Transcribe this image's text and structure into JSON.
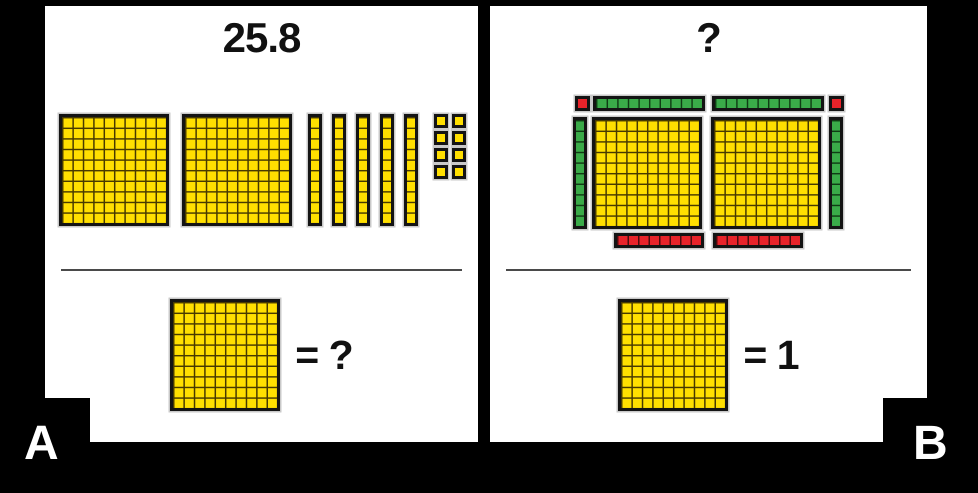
{
  "colors": {
    "bg": "#000000",
    "panel": "#ffffff",
    "ink": "#111111",
    "yellow": "#ffdf00",
    "ygrid": "#473a00",
    "green": "#3aab49",
    "ggrid": "#0f3d14",
    "red": "#e8232a",
    "rgrid": "#4d0b0e",
    "line": "#141414",
    "halo": "#c9c9c9",
    "sep": "#4a4a4a"
  },
  "panel_a": {
    "corner_label": "A",
    "title": "25.8",
    "blocks": {
      "flats": 2,
      "rods": 5,
      "units": 8
    },
    "legend": {
      "block": "hundred-square-flat",
      "label": "= ?"
    }
  },
  "panel_b": {
    "corner_label": "B",
    "title": "?",
    "blocks": {
      "yellow_flats": 2,
      "green_rods_top": 2,
      "green_rods_sides": 2,
      "red_corner_units": 2,
      "red_strips": 2,
      "red_strip_cells": 8
    },
    "legend": {
      "block": "hundred-square-flat",
      "label": "= 1"
    }
  }
}
